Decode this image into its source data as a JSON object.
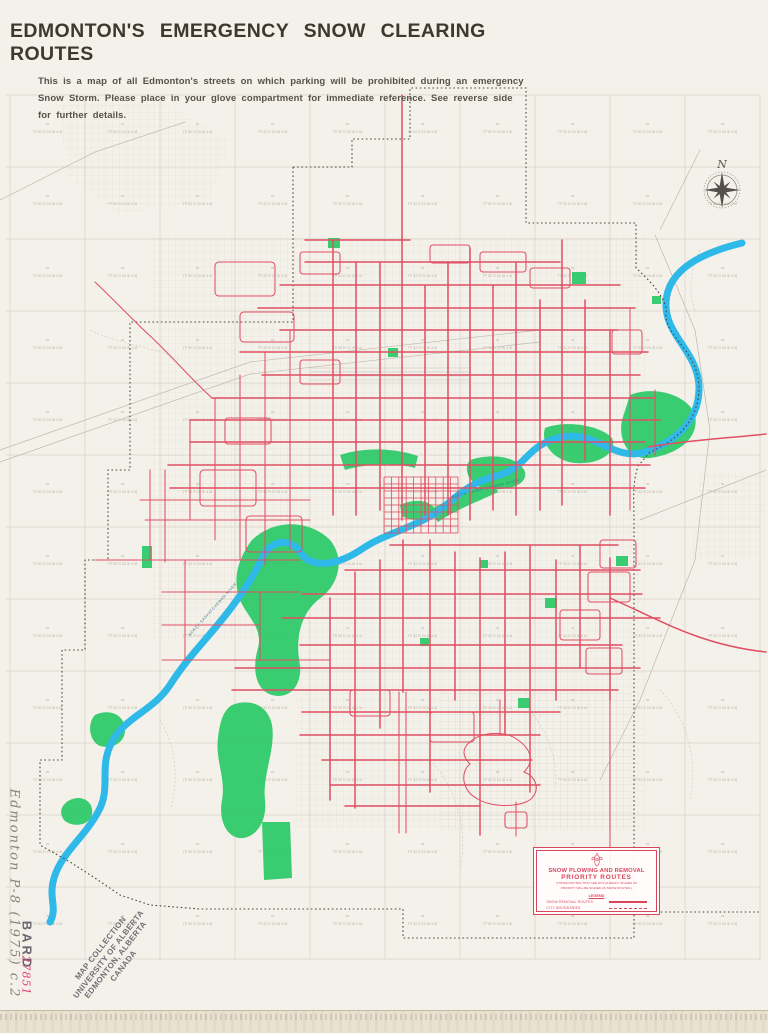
{
  "page": {
    "title": "EDMONTON'S EMERGENCY SNOW CLEARING ROUTES",
    "subtitle_lines": [
      "This is a map of all Edmonton's streets on which parking will be prohibited during an emergency",
      "Snow Storm. Please place in your glove compartment for immediate reference. See reverse side",
      "for further details."
    ]
  },
  "legend": {
    "title_line1": "SNOW PLOWING AND REMOVAL",
    "title_line2": "PRIORITY ROUTES",
    "note_line1": "(THOSE ROUTES THAT ARE NOT ALREADY SIGNED AS",
    "note_line2": "PRIORITY WILL BE SIGNED AS SNOW ROUTES.)",
    "legend_heading": "LEGEND",
    "items": [
      {
        "label": "SNOW REMOVAL ROUTES",
        "style": "solid"
      },
      {
        "label": "CITY BOUNDARIES",
        "style": "dashed"
      }
    ]
  },
  "compass": {
    "north_label": "N"
  },
  "map": {
    "river_label": "NORTH  SASKATCHEWAN  RIVER",
    "grid_section_number": "33",
    "grid_label": "TP 52 R 24 W 4 M",
    "grid": {
      "cols": 10,
      "rows": 12,
      "x0": 10,
      "y0": 95,
      "cell_w": 75,
      "cell_h": 72
    }
  },
  "annotations": {
    "handwritten_call_number": "Edmonton  P-8  (1975)  c.2",
    "accession_stamp": "BARD",
    "accession_number": "27851",
    "collection_stamp_lines": [
      "MAP COLLECTION",
      "UNIVERSITY OF ALBERTA",
      "EDMONTON, ALBERTA",
      "CANADA"
    ]
  },
  "colors": {
    "paper": "#f4f1ea",
    "route_red": "#e04f63",
    "legend_red": "#d9465c",
    "river_blue": "#2fb9e9",
    "park_green": "#2fc96a",
    "boundary_black": "#4a463f",
    "grid_gray": "#d8d3c9",
    "pencil_gray": "#8a8377",
    "stamp_purple": "#534c5a",
    "accession_pink": "#e23f74"
  }
}
